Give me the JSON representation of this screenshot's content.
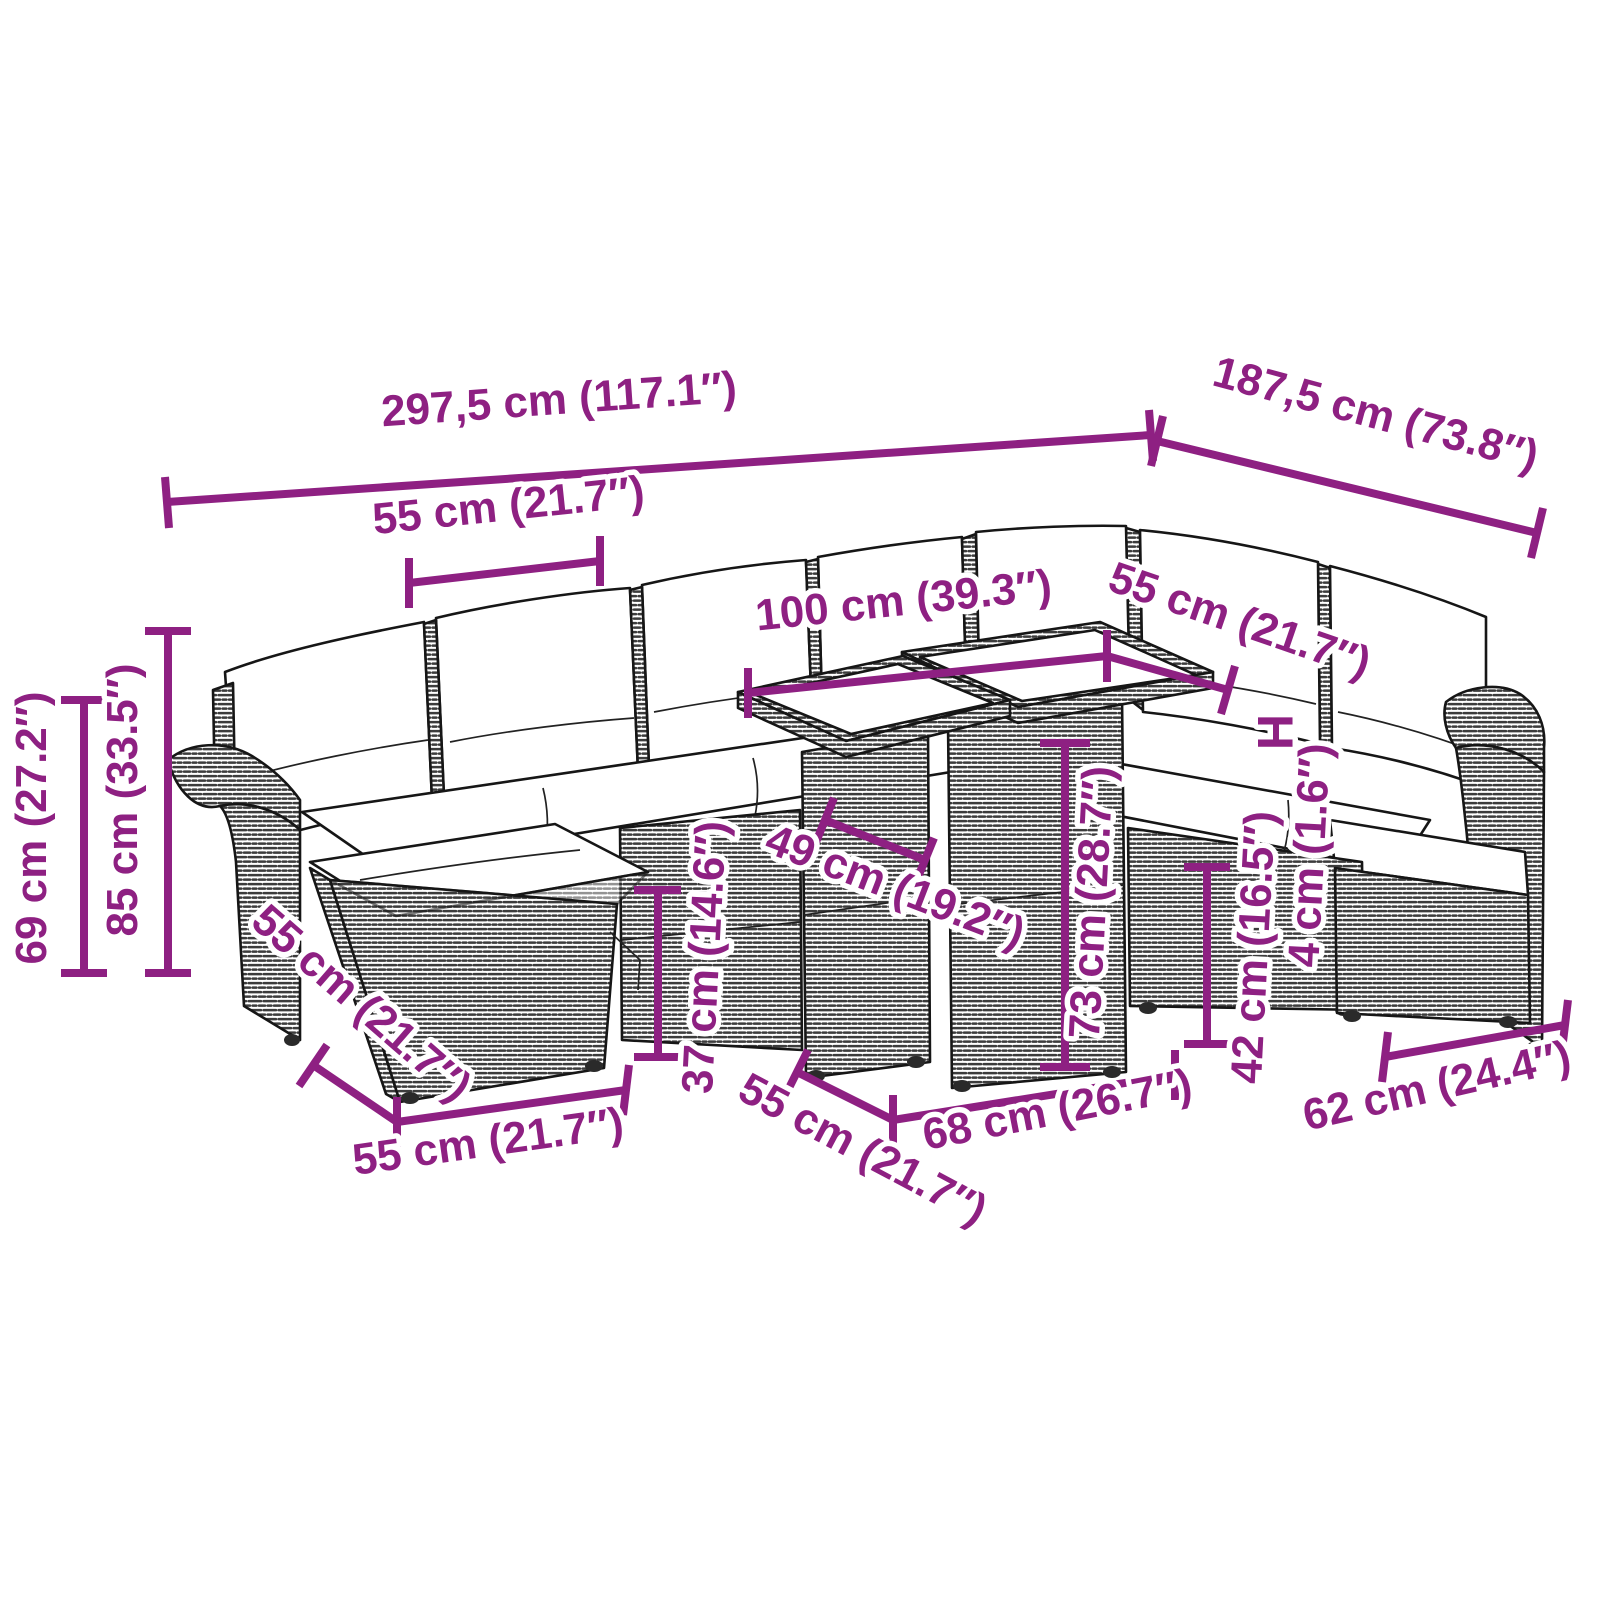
{
  "accent_color": "#8E2082",
  "figure": {
    "type": "product-dimension-diagram",
    "subject": "garden-lounge-set-with-table"
  },
  "labels": {
    "total_width": "297,5 cm (117.1″)",
    "total_depth": "187,5 cm (73.8″)",
    "seat_width_top": "55 cm (21.7″)",
    "table_width": "100 cm (39.3″)",
    "seat_width_right": "55 cm (21.7″)",
    "height_symbol": "H",
    "cushion_thickness": "4 cm (1.6″)",
    "back_height": "69 cm (27.2″)",
    "total_height": "85 cm (33.5″)",
    "ottoman_depth": "55 cm (21.7″)",
    "ottoman_width": "55 cm (21.7″)",
    "ottoman_height": "37 cm (14.6″)",
    "table_clearance_width": "49 cm (19.2″)",
    "table_height": "73 cm (28.7″)",
    "table_depth": "55 cm (21.7″)",
    "table_top_width": "68 cm (26.7″)",
    "seat_height": "42 cm (16.5″)",
    "armchair_width": "62 cm (24.4″)"
  }
}
